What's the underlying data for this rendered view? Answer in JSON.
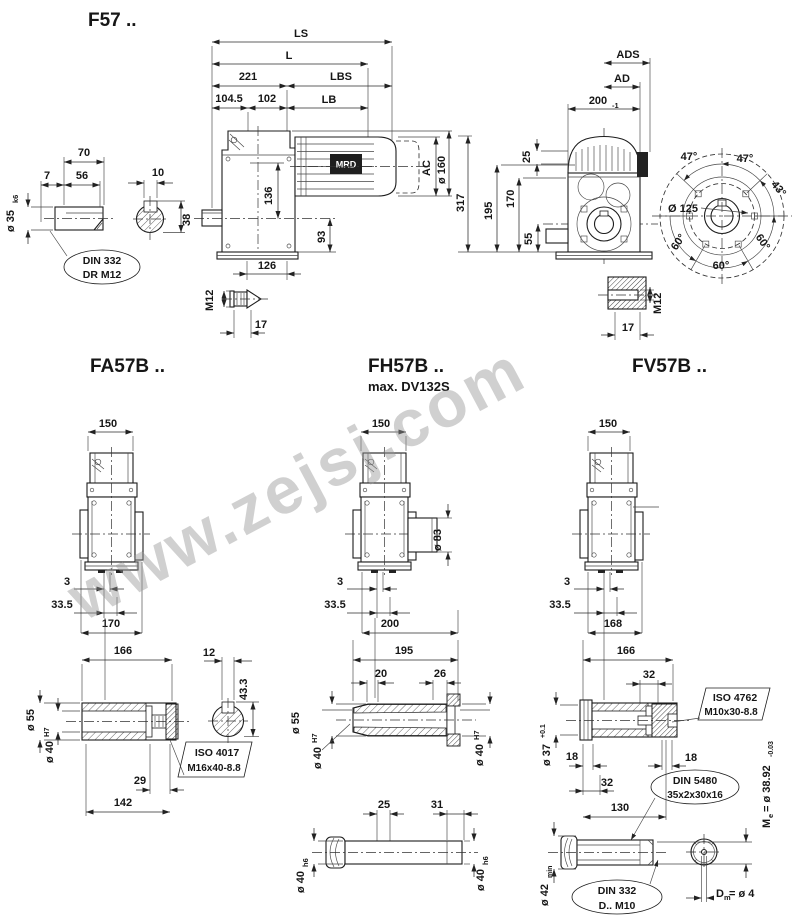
{
  "watermark": "www.zejsj.com",
  "f57": {
    "title": "F57 ..",
    "detail": {
      "d70": "70",
      "d7": "7",
      "d56": "56",
      "dia35": "ø 35",
      "dia35_tol": "k6",
      "d10": "10",
      "d38": "38",
      "note_line1": "DIN 332",
      "note_line2": "DR M12"
    },
    "side": {
      "ls": "LS",
      "l": "L",
      "d221": "221",
      "lbs": "LBS",
      "d104_5": "104.5",
      "d102": "102",
      "lb": "LB",
      "motor_label": "MRD",
      "ac": "AC",
      "dia160": "ø 160",
      "d317": "317",
      "d136": "136",
      "d93": "93",
      "d126": "126",
      "m12": "M12",
      "d17": "17"
    },
    "rear": {
      "ads": "ADS",
      "ad": "AD",
      "d200": "200",
      "d200_tol": "-1",
      "d25": "25",
      "d195": "195",
      "d170": "170",
      "d55": "55",
      "d17": "17",
      "m12": "M12"
    },
    "flange": {
      "a47_left": "47°",
      "a47_right": "47°",
      "a43": "43°",
      "dia125": "Ø 125",
      "a60_left": "60°",
      "a60_bottom": "60°",
      "a60_right": "60°"
    }
  },
  "fa57b": {
    "title": "FA57B ..",
    "view": {
      "d150": "150",
      "d3": "3",
      "d33_5": "33.5",
      "d170": "170"
    },
    "shaft": {
      "d166": "166",
      "d12": "12",
      "d43_3": "43.3",
      "dia55": "ø 55",
      "dia40": "ø 40",
      "dia40_tol": "H7",
      "iso_line1": "ISO 4017",
      "iso_line2": "M16x40-8.8",
      "d29": "29",
      "d142": "142"
    }
  },
  "fh57b": {
    "title": "FH57B ..",
    "subtitle": "max. DV132S",
    "view": {
      "d150": "150",
      "dia83": "ø 83",
      "d3": "3",
      "d33_5": "33.5",
      "d200": "200"
    },
    "shaft": {
      "d195": "195",
      "d20": "20",
      "d26": "26",
      "dia55": "ø 55",
      "dia40_left": "ø 40",
      "dia40_left_tol": "H7",
      "dia40_right": "ø 40",
      "dia40_right_tol": "H7",
      "d25": "25",
      "d31": "31",
      "dia40h6_left": "ø 40",
      "dia40h6_left_tol": "h6",
      "dia40h6_right": "ø 40",
      "dia40h6_right_tol": "h6"
    }
  },
  "fv57b": {
    "title": "FV57B ..",
    "view": {
      "d150": "150",
      "d3": "3",
      "d33_5": "33.5",
      "d168": "168"
    },
    "shaft": {
      "d166": "166",
      "d32_top": "32",
      "iso_line1": "ISO 4762",
      "iso_line2": "M10x30-8.8",
      "dia37": "ø 37",
      "dia37_tol": "+0.1",
      "d18_left": "18",
      "d18_right": "18",
      "d32_bottom": "32",
      "din5480_line1": "DIN 5480",
      "din5480_line2": "35x2x30x16",
      "d130": "130",
      "me_prefix": "M",
      "me_sub": "e",
      "me_value": "= ø 38.92",
      "me_tol": "-0.03",
      "dia42": "ø 42",
      "dia42_suffix": "min",
      "din332_line1": "DIN 332",
      "din332_line2": "D.. M10",
      "dm_prefix": "D",
      "dm_sub": "m",
      "dm_value": "= ø 4"
    }
  }
}
